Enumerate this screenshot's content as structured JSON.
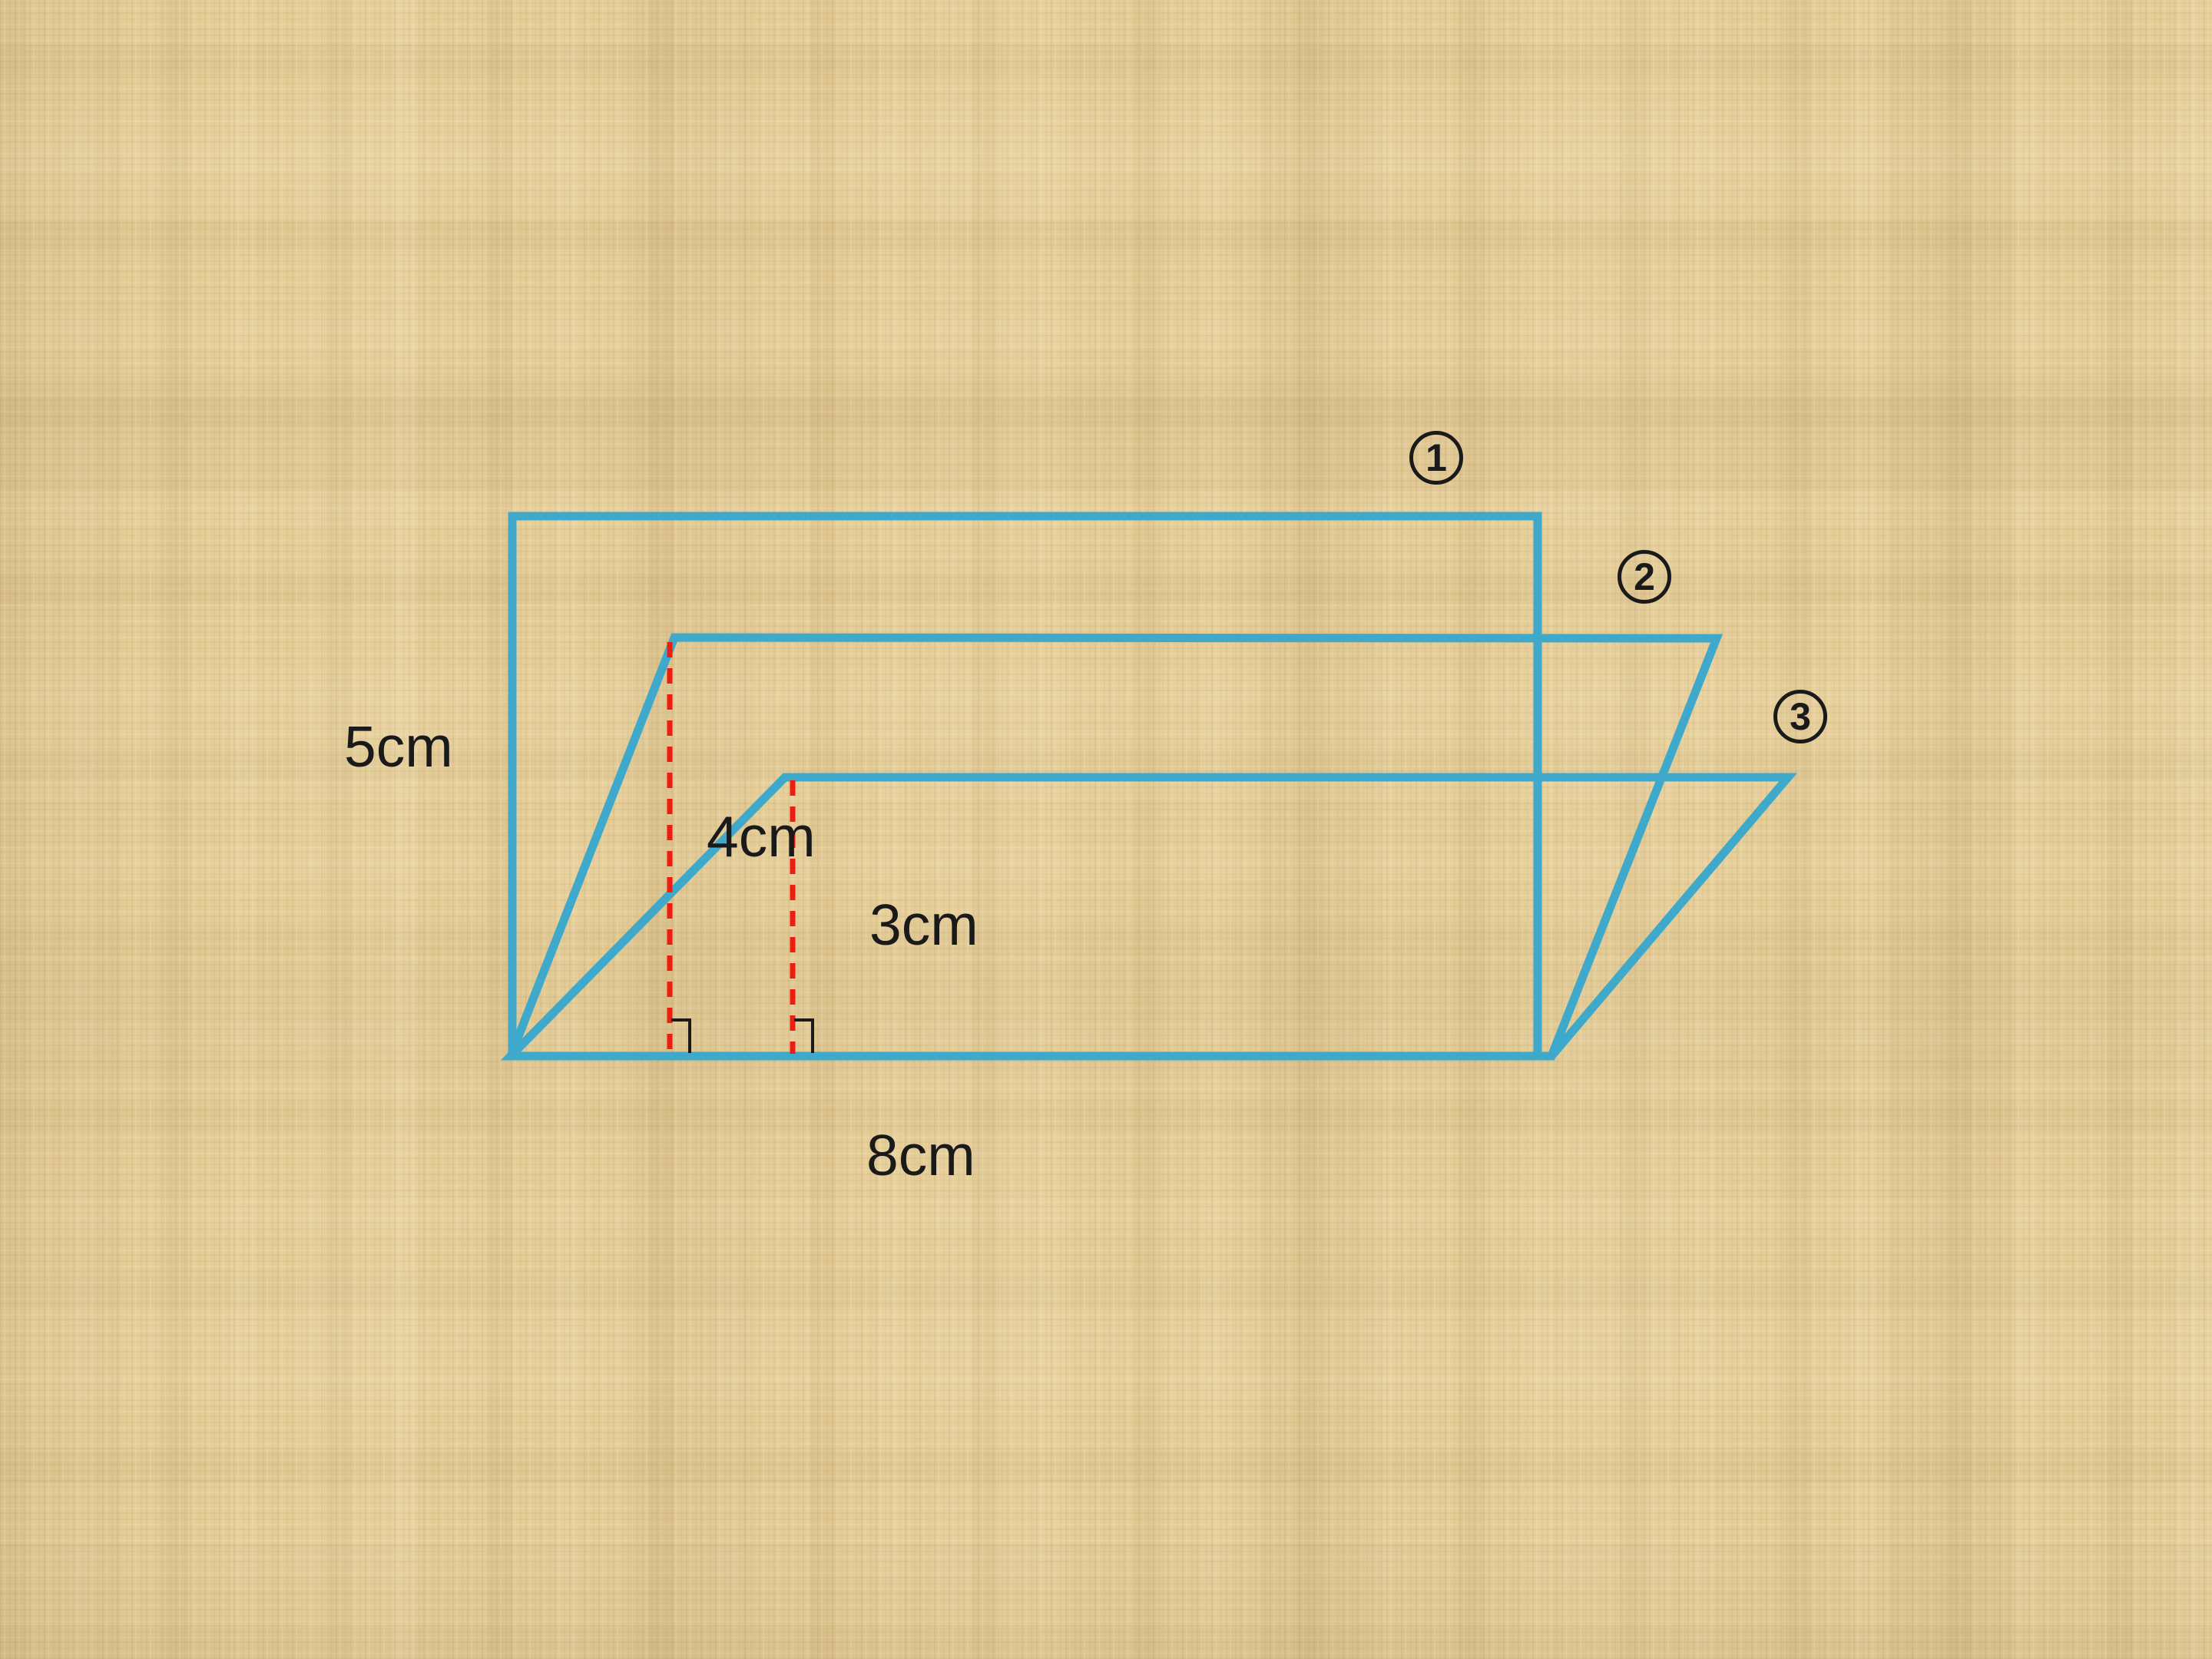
{
  "figure": {
    "dimensions": {
      "side": "5cm",
      "height_2": "4cm",
      "height_3": "3cm",
      "base": "8cm"
    },
    "shape_numbers": [
      {
        "number": "1"
      },
      {
        "number": "2"
      },
      {
        "number": "3"
      }
    ]
  },
  "colors": {
    "background": "#e5cd98",
    "shape-line": "#3fa9cc",
    "height-line": "#ee1c11",
    "ink": "#1a1a1a"
  }
}
